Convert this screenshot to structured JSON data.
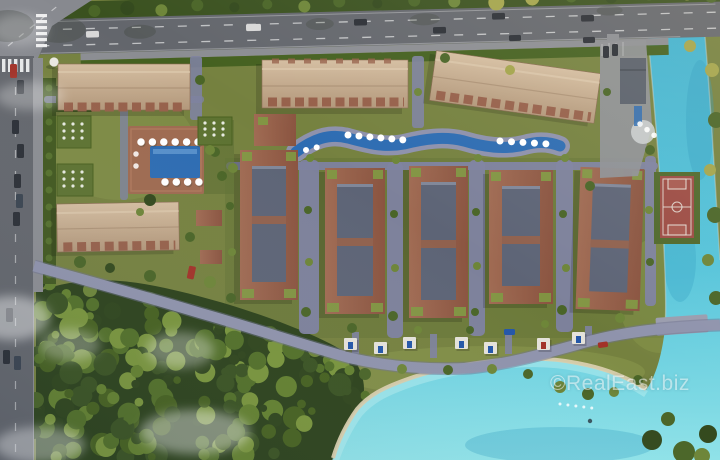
{
  "watermark": {
    "text": "©RealEast.biz"
  },
  "colors": {
    "grass": "#75813f",
    "grass_dark": "#5d7034",
    "grass_light": "#8c9a4e",
    "tree_dark": "#33491d",
    "tree_mid": "#4a6527",
    "tree_light": "#6d8538",
    "tree_yellow": "#a3a44b",
    "road": "#63666c",
    "road_light": "#87898f",
    "sidewalk": "#8b8d92",
    "path": "#7e82a0",
    "brick": "#96604a",
    "slate": "#5d6476",
    "roof_tan": "#c9b095",
    "pool": "#2d6cb2",
    "canal": "#41b2cf",
    "lagoon_light": "#8fe2e8",
    "sand": "#d8cfae",
    "court": "#9c4b43",
    "court_light": "#a85a50",
    "car_dark": "#2b2f36",
    "car_red": "#a23228",
    "car_white": "#d8d8d8",
    "car_blue": "#2356a8"
  }
}
